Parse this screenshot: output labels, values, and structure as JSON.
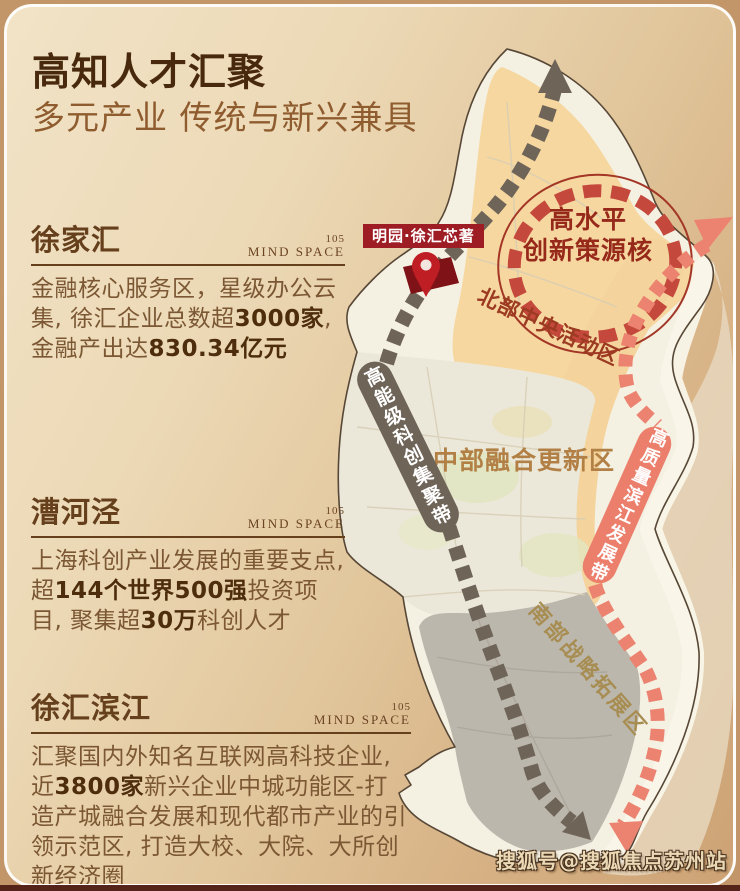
{
  "page": {
    "title": "高知人才汇聚",
    "subtitle": "多元产业 传统与新兴兼具",
    "watermark": "搜狐号@搜狐焦点苏州站"
  },
  "brand": {
    "number": "105",
    "name": "MIND SPACE"
  },
  "sections": [
    {
      "name": "徐家汇",
      "segments": [
        {
          "t": "金融核心服务区，星级办公云集, 徐汇企业总数超",
          "b": false
        },
        {
          "t": "3000家",
          "b": true
        },
        {
          "t": ", 金融产出达",
          "b": false
        },
        {
          "t": "830.34亿元",
          "b": true
        }
      ]
    },
    {
      "name": "漕河泾",
      "segments": [
        {
          "t": "上海科创产业发展的重要支点, 超",
          "b": false
        },
        {
          "t": "144个世界500强",
          "b": true
        },
        {
          "t": "投资项目, 聚集超",
          "b": false
        },
        {
          "t": "30万",
          "b": true
        },
        {
          "t": "科创人才",
          "b": false
        }
      ]
    },
    {
      "name": "徐汇滨江",
      "segments": [
        {
          "t": "汇聚国内外知名互联网高科技企业, 近",
          "b": false
        },
        {
          "t": "3800家",
          "b": true
        },
        {
          "t": "新兴企业中城功能区-打造产城融合发展和现代都市产业的引领示范区, 打造大校、大院、大所创新经济圈",
          "b": false
        }
      ]
    }
  ],
  "map": {
    "project_badge": "明园·徐汇芯著",
    "zones": {
      "core_line1": "高水平",
      "core_line2": "创新策源核",
      "north": "北部中央活动区",
      "middle": "中部融合更新区",
      "south": "南部战略拓展区"
    },
    "belts": {
      "tech": "高能级科创集聚带",
      "river": "高质量滨江发展带"
    }
  },
  "colors": {
    "title_brown": "#49290e",
    "section_brown": "#66401d",
    "accent_dark_red": "#9e1c24",
    "core_ring_red": "#c4483c",
    "belt_tech_gray": "#6f6458",
    "belt_river_salmon": "#ec7f6c",
    "zone_north_fill": "#f6d7a0",
    "zone_middle_fill": "#ebe8da",
    "zone_south_fill": "#bcb7ac",
    "district_fill": "#f4f0e2"
  }
}
